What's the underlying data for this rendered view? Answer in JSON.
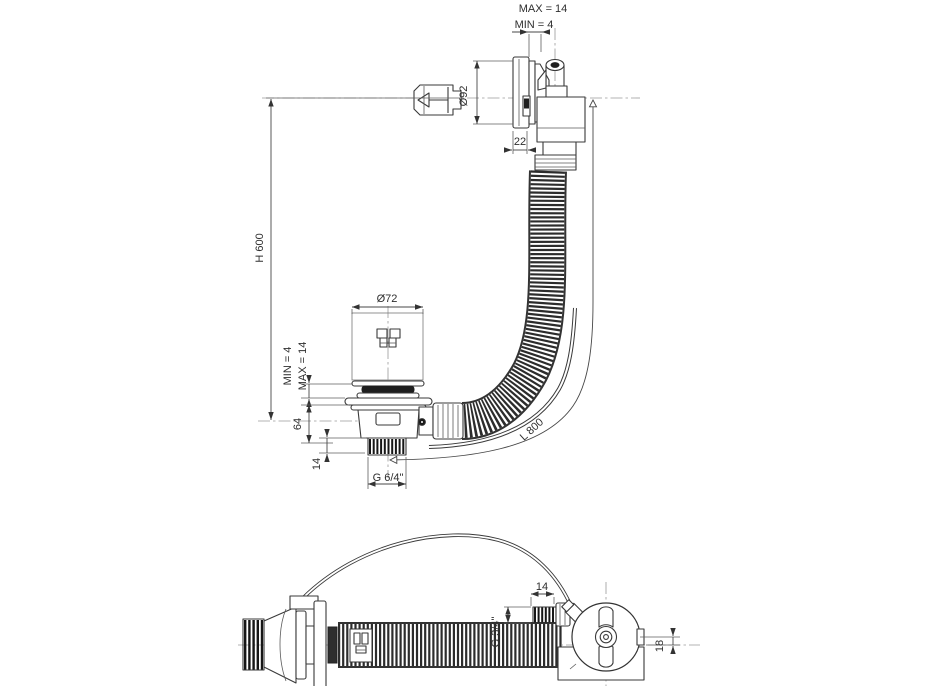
{
  "drawing": {
    "type": "technical-drawing",
    "subject": "bath waste and overflow set with flexible hose",
    "colors": {
      "background": "#ffffff",
      "line": "#3a3a3a",
      "centerline": "#9a9a9a",
      "hose_dark": "#2c2c2c",
      "thread_dark": "#161616"
    }
  },
  "dims": {
    "panel_max": "MAX = 14",
    "panel_min": "MIN = 4",
    "face_diameter": "Ø92",
    "face_offset": "22",
    "install_height": "H 600",
    "plug_diameter": "Ø72",
    "plug_min": "MIN = 4",
    "plug_max": "MAX = 14",
    "drain_height": "64",
    "drain_thread_height": "14",
    "drain_thread": "G 6/4\"",
    "hose_length": "L 800",
    "overflow_thread_length": "14",
    "overflow_thread": "G 3/4\"",
    "overflow_offset": "18"
  }
}
